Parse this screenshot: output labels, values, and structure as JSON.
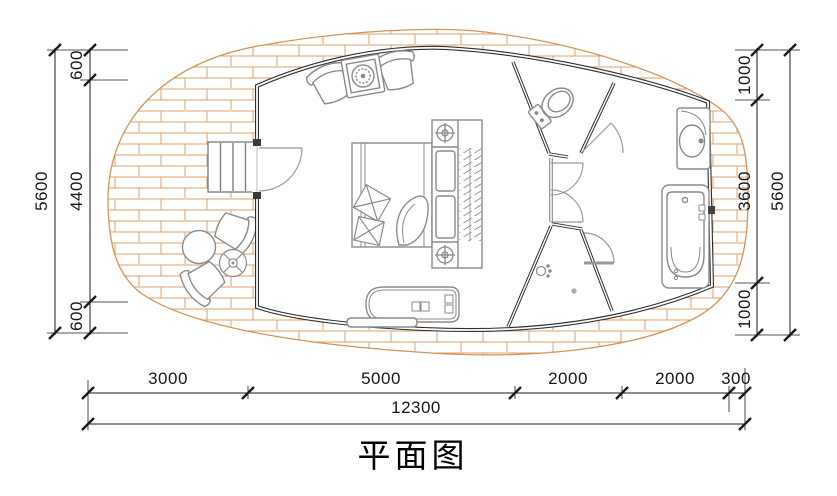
{
  "title": "平面图",
  "dimensions": {
    "left": {
      "total": "5600",
      "segments": [
        "600",
        "4400",
        "600"
      ]
    },
    "right": {
      "total": "5600",
      "segments": [
        "1000",
        "3600",
        "1000"
      ]
    },
    "bottom": {
      "segments": [
        "3000",
        "5000",
        "2000",
        "2000",
        "300"
      ],
      "total": "12300"
    }
  },
  "colors": {
    "deck_hatch": "#dfa06a",
    "wall": "#2e2e2e",
    "furniture_line": "#8a8a8a",
    "dimension_line": "#1a1a1a"
  },
  "icons": [
    "entry-stairs",
    "entry-door",
    "outdoor-armchair",
    "round-table",
    "planter-table",
    "lounge-chair",
    "stove-table",
    "double-bed",
    "pillow",
    "nightstand-lamp",
    "wardrobe-rail",
    "bench-daybed",
    "toilet",
    "interior-door",
    "shower-head",
    "floor-drain",
    "washbasin",
    "bathtub"
  ]
}
